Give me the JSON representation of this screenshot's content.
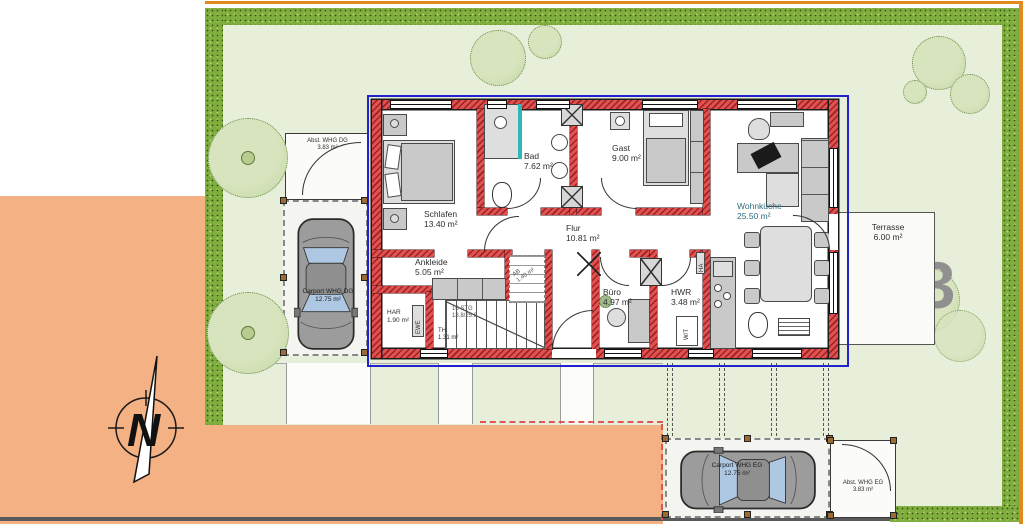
{
  "plan": {
    "watermark": "63",
    "compass": "N",
    "rooms": [
      {
        "id": "schlafen",
        "name": "Schlafen",
        "area": "13.40 m²"
      },
      {
        "id": "bad",
        "name": "Bad",
        "area": "7.62 m²"
      },
      {
        "id": "flur",
        "name": "Flur",
        "area": "10.81 m²"
      },
      {
        "id": "gast",
        "name": "Gast",
        "area": "9.00 m²"
      },
      {
        "id": "wohnkueche",
        "name": "Wohnküche",
        "area": "25.50 m²"
      },
      {
        "id": "ankleide",
        "name": "Ankleide",
        "area": "5.05 m²"
      },
      {
        "id": "har",
        "name": "HAR",
        "area": "1.90 m²"
      },
      {
        "id": "buero",
        "name": "Büro",
        "area": "4.97 m²"
      },
      {
        "id": "hwr",
        "name": "HWR",
        "area": "3.48 m²"
      },
      {
        "id": "ab",
        "name": "AB",
        "area": "1.40 m²"
      },
      {
        "id": "th",
        "name": "TH.",
        "area": "1.31 m²"
      }
    ],
    "outdoor": {
      "terrasse": {
        "name": "Terrasse",
        "area": "6.00 m²"
      },
      "abst_dg": {
        "name": "Abst. WHG DG",
        "area": "3.83 m²"
      },
      "carport_dg": {
        "name": "Carport WHG DG",
        "area": "12.75 m²"
      },
      "carport_eg": {
        "name": "Carport WHG EG",
        "area": "12.75 m²"
      },
      "abst_eg": {
        "name": "Abst. WHG EG",
        "area": "3.83 m²"
      }
    },
    "stairs": {
      "steps": "16 STG",
      "dimensions": "18.8/25.8"
    },
    "tags": {
      "ewe": "EWE",
      "wt": "W/T",
      "ha": "HA"
    },
    "colors": {
      "wall": "#d94f4c",
      "hedge": "#7fae3e",
      "lawn": "#e7efda",
      "paving": "#f4b183",
      "boundary": "#2222cc"
    }
  }
}
